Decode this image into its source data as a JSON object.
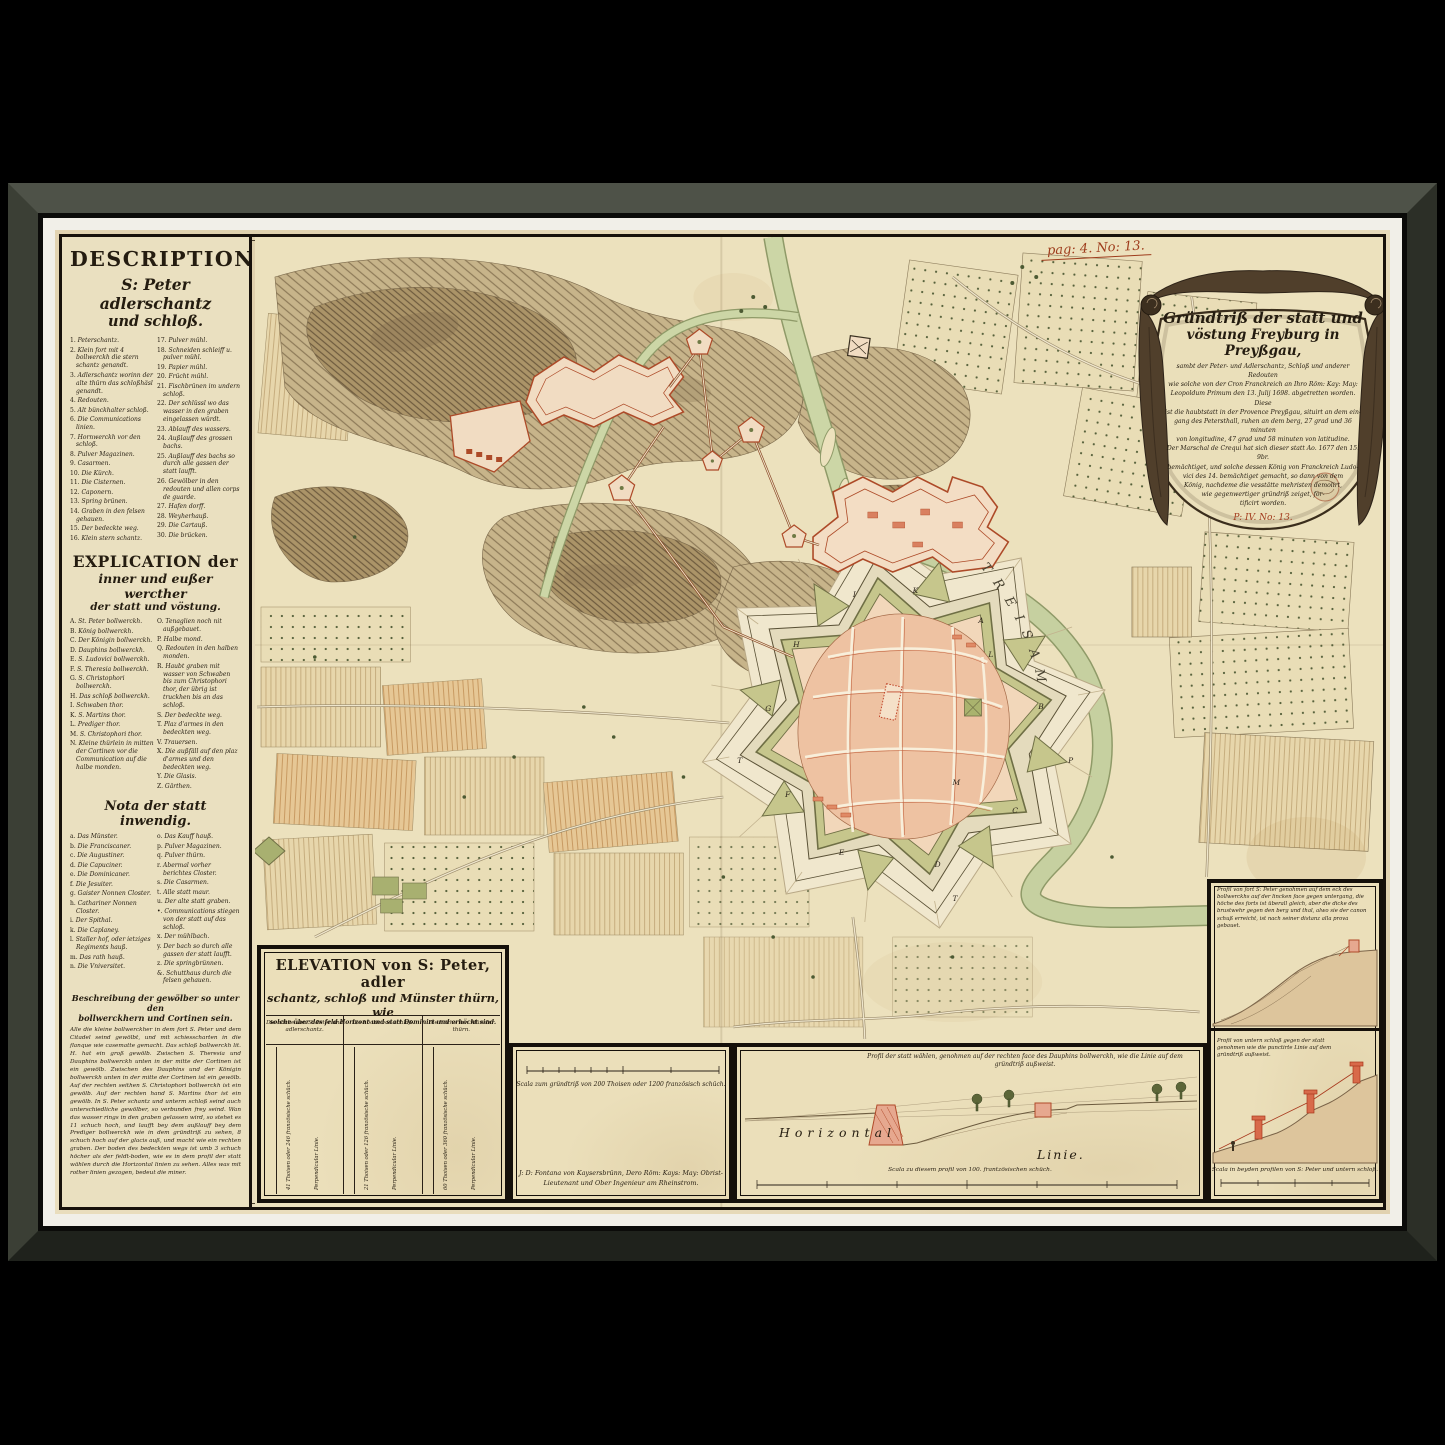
{
  "artwork": {
    "kind": "Framed antique manuscript fortification map of Freiburg im Breisgau"
  },
  "page_mark": "pag: 4. No: 13.",
  "description": {
    "title1": "DESCRIPTION",
    "title2": "S: Peter adlerschantz",
    "title3": "und schloß.",
    "items_left": [
      {
        "n": "1.",
        "t": "Peterschantz."
      },
      {
        "n": "2.",
        "t": "Klein fort mit 4 bollwerckh die stern schantz genandt."
      },
      {
        "n": "3.",
        "t": "Adlerschantz worinn der alte thürn das schloßhäsl genandt."
      },
      {
        "n": "4.",
        "t": "Redouten."
      },
      {
        "n": "5.",
        "t": "Alt bünckhalter schloß."
      },
      {
        "n": "6.",
        "t": "Die Communications linien."
      },
      {
        "n": "7.",
        "t": "Hornwerckh vor den schloß."
      },
      {
        "n": "8.",
        "t": "Pulver Magazinen."
      },
      {
        "n": "9.",
        "t": "Casarmen."
      },
      {
        "n": "10.",
        "t": "Die Kürch."
      },
      {
        "n": "11.",
        "t": "Die Cisternen."
      },
      {
        "n": "12.",
        "t": "Caponern."
      },
      {
        "n": "13.",
        "t": "Spring brünen."
      },
      {
        "n": "14.",
        "t": "Graben in den felsen gehauen."
      },
      {
        "n": "15.",
        "t": "Der bedeckte weg."
      },
      {
        "n": "16.",
        "t": "Klein stern schantz."
      }
    ],
    "items_right": [
      {
        "n": "17.",
        "t": "Pulver mühl."
      },
      {
        "n": "18.",
        "t": "Schneiden schleiff u. pulver mühl."
      },
      {
        "n": "19.",
        "t": "Papier mühl."
      },
      {
        "n": "20.",
        "t": "Frücht mühl."
      },
      {
        "n": "21.",
        "t": "Fischbrünen im undern schloß."
      },
      {
        "n": "22.",
        "t": "Der schlüssl wo das wasser in den graben eingelassen würdt."
      },
      {
        "n": "23.",
        "t": "Ablauff des wassers."
      },
      {
        "n": "24.",
        "t": "Außlauff des grossen bachs."
      },
      {
        "n": "25.",
        "t": "Außlauff des bachs so durch alle gassen der statt laufft."
      },
      {
        "n": "26.",
        "t": "Gewölber in den redouten und allen corps de guarde."
      },
      {
        "n": "27.",
        "t": "Hafen dorff."
      },
      {
        "n": "28.",
        "t": "Weyherhauß."
      },
      {
        "n": "29.",
        "t": "Die Cartauß."
      },
      {
        "n": "30.",
        "t": "Die brücken."
      }
    ]
  },
  "explication": {
    "title1": "EXPLICATION der",
    "title2": "inner und eußer wercther",
    "title3": "der statt und vöstung.",
    "items_left": [
      {
        "n": "A.",
        "t": "St. Peter bollwerckh."
      },
      {
        "n": "B.",
        "t": "König bollwerckh."
      },
      {
        "n": "C.",
        "t": "Der Königin bollwerckh."
      },
      {
        "n": "D.",
        "t": "Dauphins bollwerckh."
      },
      {
        "n": "E.",
        "t": "S. Ludovici bollwerckh."
      },
      {
        "n": "F.",
        "t": "S. Theresia bollwerckh."
      },
      {
        "n": "G.",
        "t": "S. Christophori bollwerckh."
      },
      {
        "n": "H.",
        "t": "Das schloß bollwerckh."
      },
      {
        "n": "I.",
        "t": "Schwaben thor."
      },
      {
        "n": "K.",
        "t": "S. Martins thor."
      },
      {
        "n": "L.",
        "t": "Prediger thor."
      },
      {
        "n": "M.",
        "t": "S. Christophori thor."
      },
      {
        "n": "N.",
        "t": "Kleine thürlein in mitten der Cortinen vor die Communication auf die halbe monden."
      }
    ],
    "items_right": [
      {
        "n": "O.",
        "t": "Tenaglien noch nit außgebauet."
      },
      {
        "n": "P.",
        "t": "Halbe mond."
      },
      {
        "n": "Q.",
        "t": "Redouten in den halben monden."
      },
      {
        "n": "R.",
        "t": "Haubt graben mit wasser von Schwaben bis zum Christophori thor, der übrig ist truckhen bis an das schloß."
      },
      {
        "n": "S.",
        "t": "Der bedeckte weg."
      },
      {
        "n": "T.",
        "t": "Plaz d'armes in den bedeckten weg."
      },
      {
        "n": "V.",
        "t": "Trauersen."
      },
      {
        "n": "X.",
        "t": "Die außfäll auf den plaz d'armes und den bedeckten weg."
      },
      {
        "n": "Y.",
        "t": "Die Glasis."
      },
      {
        "n": "Z.",
        "t": "Gärthen."
      }
    ]
  },
  "nota": {
    "title": "Nota der statt inwendig.",
    "items_left": [
      {
        "n": "a.",
        "t": "Das Münster."
      },
      {
        "n": "b.",
        "t": "Die Franciscaner."
      },
      {
        "n": "c.",
        "t": "Die Augustiner."
      },
      {
        "n": "d.",
        "t": "Die Capuciner."
      },
      {
        "n": "e.",
        "t": "Die Dominicaner."
      },
      {
        "n": "f.",
        "t": "Die Jesuiter."
      },
      {
        "n": "g.",
        "t": "Gaister Nonnen Closter."
      },
      {
        "n": "h.",
        "t": "Cathariner Nonnen Closter."
      },
      {
        "n": "i.",
        "t": "Der Spithal."
      },
      {
        "n": "k.",
        "t": "Die Caplaney."
      },
      {
        "n": "l.",
        "t": "Staller hof, oder ietziges Regiments hauß."
      },
      {
        "n": "m.",
        "t": "Das rath hauß."
      },
      {
        "n": "n.",
        "t": "Die Vniversitet."
      }
    ],
    "items_right": [
      {
        "n": "o.",
        "t": "Das Kauff hauß."
      },
      {
        "n": "p.",
        "t": "Pulver Magazinen."
      },
      {
        "n": "q.",
        "t": "Pulver thürn."
      },
      {
        "n": "r.",
        "t": "Abermal vorher berichtes Closter."
      },
      {
        "n": "s.",
        "t": "Die Casarmen."
      },
      {
        "n": "t.",
        "t": "Alle statt maur."
      },
      {
        "n": "u.",
        "t": "Der alte statt graben."
      },
      {
        "n": "•.",
        "t": "Communications stiegen von der statt auf das schloß."
      },
      {
        "n": "x.",
        "t": "Der mühlbach."
      },
      {
        "n": "y.",
        "t": "Der bach so durch alle gassen der statt laufft."
      },
      {
        "n": "z.",
        "t": "Die springbrünnen."
      },
      {
        "n": "&.",
        "t": "Schutthaus durch die felsen gehauen."
      }
    ]
  },
  "beschreibung": {
    "title1": "Beschreibung der gewölber so unter den",
    "title2": "bollwerckhern und Cortinen sein.",
    "body": "Alle die kleine bollwerckher in dem fort S. Peter und dem Citadel seind gewölbt, und mit schiesscharten in die flanque wie casematte gemacht. Das schloß bollwerckh lit. H. hat ein groß gewölb. Zwischen S. Theresia und Dauphins bollwerckh unten in der mitte der Cortinen ist ein gewölb. Zwischen des Dauphins und der Königin bollwerckh unten in der mitte der Cortinen ist ein gewölb. Auf der rechten seithen S. Christophori bollwerckh ist ein gewölb. Auf der rechten hand S. Martins thor ist ein gewölb. In S. Peter schantz und unterm schloß seind auch unterschiedliche gewölber, so verbunden frey seind. Wan das wasser rings in den graben gelassen wird, so stehet es 11 schuch hoch, und laufft bey dem außlauff bey dem Prediger bollwerckh wie in dem gründtriß zu sehen, 8 schuch hoch auf der glacis auß, und macht wie ein rechten graben. Der boden des bedeckten wegs ist umb 3 schuch höcher als der feldt-boden, wie es in dem profil der statt wählen durch die Horizontal linien zu sehen. Alles was mit rother linien gezogen, bedeut die miner."
  },
  "cartouche": {
    "line1": "Gründtriß der statt und",
    "line2": "vöstung Freyburg in Preyßgau,",
    "body": [
      "sambt der Peter- und Adlerschantz, Schloß und anderer Redouten",
      "wie solche von der Cron Franckreich an Ihro Röm: Kay: May:",
      "Leopoldum Primum den 13. Julij 1698. abgetretten worden. Diese",
      "ist die haubtstatt in der Provence Preyßgau, situirt an dem ein-",
      "gang des Petersthall, ruhen an dem berg, 27 grad und 36 minuten",
      "von longitudine, 47 grad und 58 minuten von latitudine.",
      "Der Marschal de Crequi hat sich dieser statt Ao. 1677 den 15. 9br.",
      "bemächtiget, und solche dessen König von Franckreich Ludo-",
      "vici des 14. bemächtiget gemacht, so dann von dem",
      "König, nachdeme die vesstätte mehristen demolirt,",
      "wie gegenwertiger gründriß zeiget, for-",
      "tificirt worden."
    ],
    "mark": "P: IV. No: 13."
  },
  "elevation": {
    "title1": "ELEVATION von S: Peter, adler",
    "title2": "schantz, schloß und Münster thürn, wie",
    "title3": "solche über das feld Horizont und statt Dominirt und erhöcht sind.",
    "columns": [
      {
        "header": "Die höche von S: Peter und adlerschantz.",
        "measure": "41 Thoisen oder 246 französische schüch.",
        "line": "Perpendicular Linie."
      },
      {
        "header": "Die höche von schloß.",
        "measure": "21 Thoisen oder 126 französische schüch.",
        "line": "Perpendicular Linie."
      },
      {
        "header": "Die höche von Münster thürn.",
        "measure": "60 Thoisen oder 360 französische schüch.",
        "line": "Perpendicular Linie."
      }
    ]
  },
  "scale_panel": {
    "scala": "Scala zum gründtriß von 200 Thoisen oder 1200 französisch schüch.",
    "signature1": "J: D: Fontana von Kaysersbrünn, Dero Röm: Kays: May: Obrist-",
    "signature2": "Lieutenant und Ober Ingenieur am Rheinstrom."
  },
  "profile_mid": {
    "title1": "Profil der statt wählen, genohmen auf der rechten face des Dauphins bollwerckh, wie die Linie auf dem",
    "title2": "gründtriß außweist.",
    "horizontal": "Horizontal",
    "linie": "Linie.",
    "scala": "Scala zu diesem profil von 100. frantzösischen schüch."
  },
  "profiles_right": {
    "p1_title": "Profil von fort S: Peter genohmen auf dem eck des bollwerckhs auf der lincken face gegen untergang, die höche des forts ist überall gleich, aber die dicke des brustwehr gegen den berg und thal, alwo sie der canon schuß erreicht, ist nach seiner distanz alla prova gebauet.",
    "p2_title": "Profil von untern schloß gegen der statt genohmen wie die punctirte Linie auf dem gründtriß außweist.",
    "scala": "Scala in beyden profilen von S: Peter und untern schloß."
  },
  "map": {
    "river_label": "TREISAM",
    "bastion_letters": [
      "A",
      "B",
      "C",
      "D",
      "E",
      "F",
      "G",
      "H",
      "I",
      "K",
      "L",
      "M",
      "T",
      "T",
      "P"
    ]
  }
}
